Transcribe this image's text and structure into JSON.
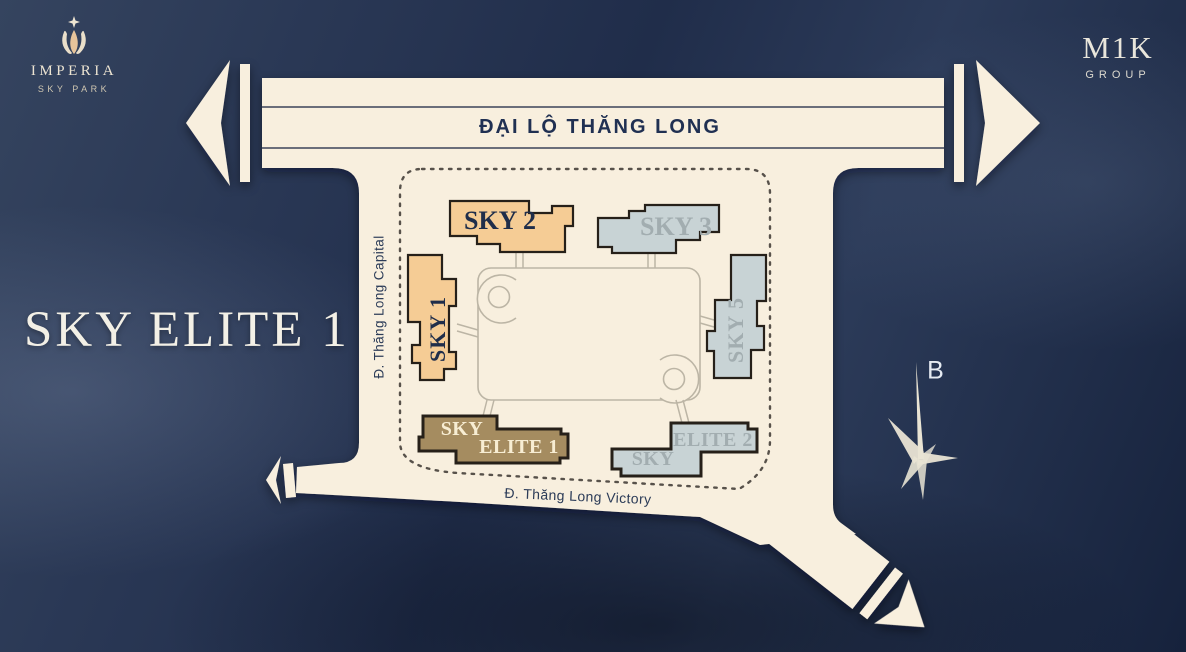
{
  "branding": {
    "imperia": {
      "name": "IMPERIA",
      "subtitle": "SKY PARK"
    },
    "mik": {
      "name": "M1K",
      "subtitle": "GROUP"
    }
  },
  "hero_title": "SKY ELITE 1",
  "compass": {
    "north_label": "B"
  },
  "roads": {
    "main_avenue": "ĐẠI LỘ THĂNG LONG",
    "west_street": "Đ. Thăng Long Capital",
    "south_street": "Đ. Thăng Long Victory"
  },
  "site_plan": {
    "buildings": [
      {
        "id": "sky-1",
        "label": "SKY 1",
        "style": "orange"
      },
      {
        "id": "sky-2",
        "label": "SKY 2",
        "style": "orange"
      },
      {
        "id": "sky-3",
        "label": "SKY 3",
        "style": "gray"
      },
      {
        "id": "sky-5",
        "label": "SKY 5",
        "style": "gray"
      },
      {
        "id": "sky-elite-1",
        "label_top": "SKY",
        "label_bottom": "ELITE 1",
        "style": "brown-highlight"
      },
      {
        "id": "sky-elite-2",
        "label_top": "SKY",
        "label_bottom": "ELITE 2",
        "style": "gray"
      }
    ]
  },
  "colors": {
    "background_navy": "#22304d",
    "road_cream": "#f8efde",
    "building_orange": "#f5cc95",
    "building_gray": "#c8d3d5",
    "building_brown": "#a58c60",
    "outline_dark": "#262019",
    "text_navy": "#1f2d4a",
    "text_gray": "#a2adb0",
    "text_cream": "#f7edd3"
  }
}
